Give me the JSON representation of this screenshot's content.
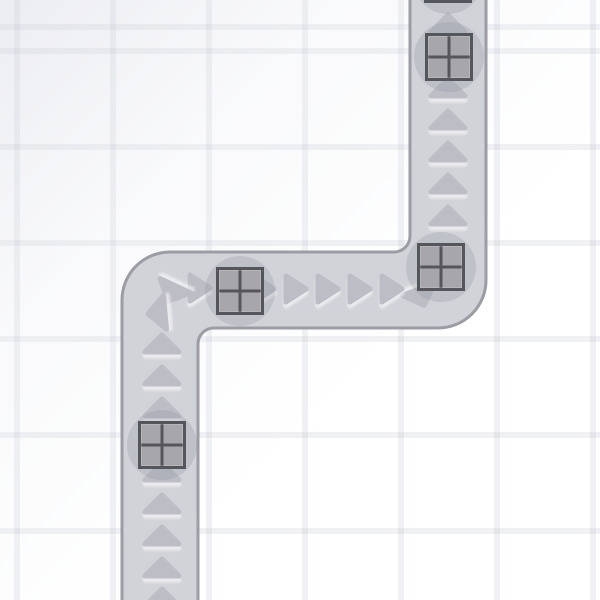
{
  "scene": {
    "description": "tower-defense conveyor track with crates",
    "colors": {
      "background": "#ffffff",
      "grid_line": "rgba(165,170,186,0.17)",
      "track_fill": "#d2d3d9",
      "track_border": "#9b9ca4",
      "arrow": "#bcbdc5",
      "crate_shadow_disc": "rgba(150,152,165,0.30)",
      "crate_fill": "#a7a7ab",
      "crate_frame": "#55565c"
    },
    "grid": {
      "cell_size": 96,
      "offset_x": 14,
      "offset_y": 48,
      "line_width": 6
    },
    "track": {
      "width": 76,
      "border_width": 3,
      "outer_corner_radius": 48,
      "inner_corner_radius": 16,
      "path_d": "M122,612 V300 A48,48 0 0 1 170,252 H394 A16,16 0 0 0 410,236 V-12 H486 V280 A48,48 0 0 1 438,328 H214 A16,16 0 0 0 198,344 V612 Z",
      "segments": [
        {
          "name": "bottom-vertical",
          "x1": 122,
          "x2": 198,
          "y1": 328,
          "y2": 600,
          "flow": "up"
        },
        {
          "name": "middle-horizontal",
          "y1": 252,
          "y2": 328,
          "x1": 122,
          "x2": 486,
          "flow": "right"
        },
        {
          "name": "top-vertical",
          "x1": 410,
          "x2": 486,
          "y1": 0,
          "y2": 328,
          "flow": "up"
        }
      ]
    },
    "arrow_shapes": {
      "up": "M-17,8 L0,-9 L17,8 Z",
      "right": "M-10,-13 L10,0 L-10,13 Z"
    },
    "arrows": [
      {
        "x": 448,
        "y": 24,
        "shape": "up",
        "rot": 0
      },
      {
        "x": 448,
        "y": 56,
        "shape": "up",
        "rot": 0
      },
      {
        "x": 448,
        "y": 88,
        "shape": "up",
        "rot": 0
      },
      {
        "x": 448,
        "y": 120,
        "shape": "up",
        "rot": 0
      },
      {
        "x": 448,
        "y": 152,
        "shape": "up",
        "rot": 0
      },
      {
        "x": 448,
        "y": 184,
        "shape": "up",
        "rot": 0
      },
      {
        "x": 448,
        "y": 216,
        "shape": "up",
        "rot": 0
      },
      {
        "x": 421,
        "y": 297,
        "shape": "up",
        "rot": 160
      },
      {
        "x": 392,
        "y": 289,
        "shape": "right",
        "rot": 0
      },
      {
        "x": 360,
        "y": 289,
        "shape": "right",
        "rot": 0
      },
      {
        "x": 328,
        "y": 289,
        "shape": "right",
        "rot": 0
      },
      {
        "x": 296,
        "y": 289,
        "shape": "right",
        "rot": 0
      },
      {
        "x": 264,
        "y": 289,
        "shape": "right",
        "rot": 0
      },
      {
        "x": 232,
        "y": 289,
        "shape": "right",
        "rot": 0
      },
      {
        "x": 200,
        "y": 288,
        "shape": "right",
        "rot": 0
      },
      {
        "x": 172,
        "y": 293,
        "shape": "up",
        "rot": 205
      },
      {
        "x": 157,
        "y": 313,
        "shape": "up",
        "rot": 265
      },
      {
        "x": 162,
        "y": 344,
        "shape": "up",
        "rot": 0
      },
      {
        "x": 162,
        "y": 376,
        "shape": "up",
        "rot": 0
      },
      {
        "x": 162,
        "y": 408,
        "shape": "up",
        "rot": 0
      },
      {
        "x": 162,
        "y": 440,
        "shape": "up",
        "rot": 0
      },
      {
        "x": 162,
        "y": 472,
        "shape": "up",
        "rot": 0
      },
      {
        "x": 162,
        "y": 504,
        "shape": "up",
        "rot": 0
      },
      {
        "x": 162,
        "y": 536,
        "shape": "up",
        "rot": 0
      },
      {
        "x": 162,
        "y": 568,
        "shape": "up",
        "rot": 0
      },
      {
        "x": 162,
        "y": 598,
        "shape": "up",
        "rot": 0
      }
    ],
    "crate_size": 48,
    "disc_radius": 35,
    "crates": [
      {
        "x": 424,
        "y": -45,
        "note": "partially off-screen at top"
      },
      {
        "x": 425,
        "y": 33
      },
      {
        "x": 417,
        "y": 243
      },
      {
        "x": 216,
        "y": 267
      },
      {
        "x": 138,
        "y": 421
      }
    ]
  }
}
